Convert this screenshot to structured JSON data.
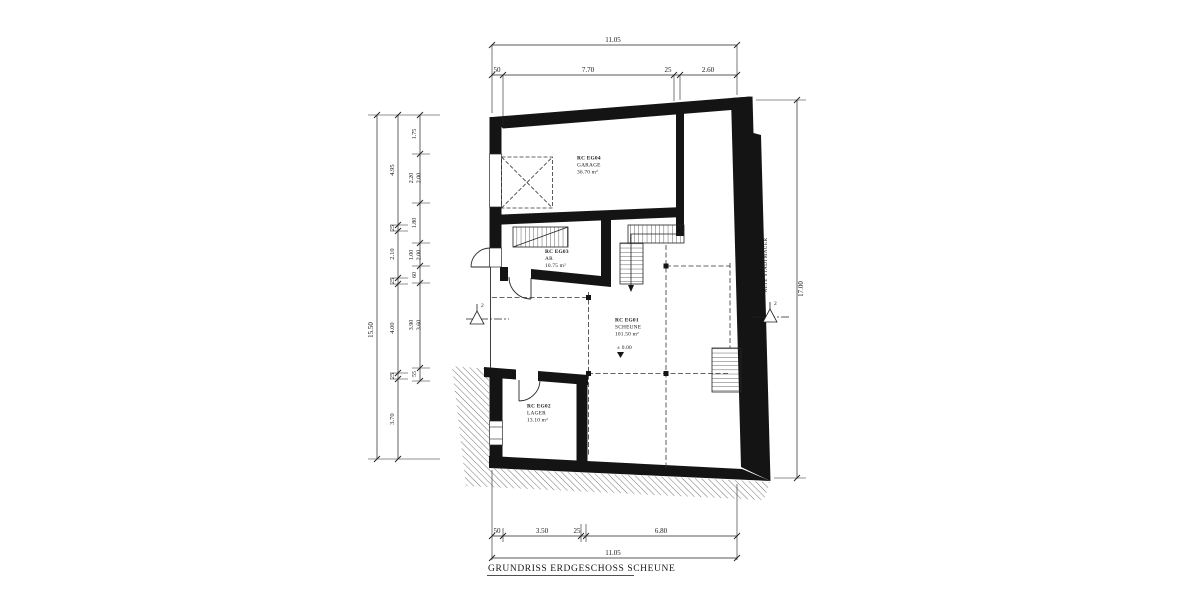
{
  "title": "GRUNDRISS ERDGESCHOSS SCHEUNE",
  "rooms": {
    "garage": {
      "id": "RC EG04",
      "name": "GARAGE",
      "area": "36.70 m²"
    },
    "ar": {
      "id": "RC EG03",
      "name": "AR",
      "area": "10.75 m²"
    },
    "scheune": {
      "id": "RC EG01",
      "name": "SCHEUNE",
      "area": "101.50 m²",
      "level": "± 0.00"
    },
    "lager": {
      "id": "RC EG02",
      "name": "LAGER",
      "area": "13.10 m²"
    }
  },
  "annotations": {
    "wall_label": "ALTE STADTMAUER",
    "section_left": "2",
    "section_right": "2"
  },
  "dimensions": {
    "top": {
      "total": "11.05",
      "segments": [
        "50",
        "7.70",
        "25",
        "2.60"
      ]
    },
    "bottom": {
      "total": "11.05",
      "segments": [
        "50",
        "3.50",
        "25",
        "6.80"
      ]
    },
    "left": {
      "total": "15.50",
      "outer_chain": [
        "4.95",
        "25",
        "2.10",
        "25",
        "4.00",
        "25",
        "3.70"
      ],
      "inner_chain": [
        "1.75",
        "2.20",
        "2.00",
        "1.80",
        "1.00",
        "2.00",
        "60",
        "3.90",
        "3.60",
        "55"
      ]
    },
    "right": {
      "total": "17.00"
    }
  },
  "colors": {
    "ink": "#1c1c1c",
    "paper": "#ffffff"
  }
}
